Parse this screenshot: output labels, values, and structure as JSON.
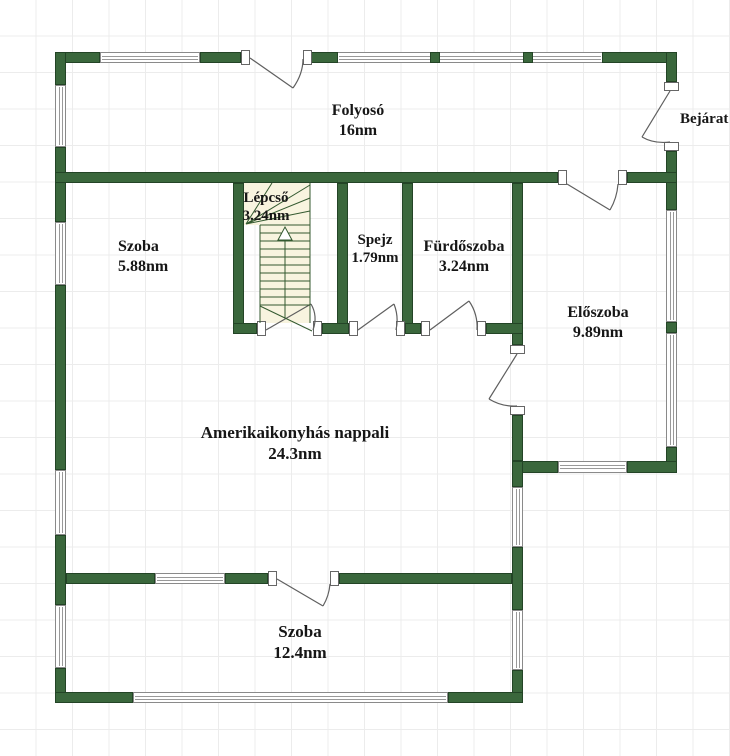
{
  "plan": {
    "rooms": [
      {
        "name": "Folyosó",
        "area": "16nm"
      },
      {
        "name": "Szoba",
        "area": "5.88nm"
      },
      {
        "name": "Lépcső",
        "area": "3.24nm"
      },
      {
        "name": "Spejz",
        "area": "1.79nm"
      },
      {
        "name": "Fürdőszoba",
        "area": "3.24nm"
      },
      {
        "name": "Előszoba",
        "area": "9.89nm"
      },
      {
        "name": "Amerikaikonyhás nappali",
        "area": "24.3nm"
      },
      {
        "name": "Szoba",
        "area": "12.4nm"
      }
    ],
    "entrance_label": "Bejárat",
    "colors": {
      "wall": "#3a673c",
      "stair_fill": "#f8f4df",
      "grid_line": "#ececec",
      "door_line": "#5f5f5f",
      "text": "#161616"
    }
  }
}
